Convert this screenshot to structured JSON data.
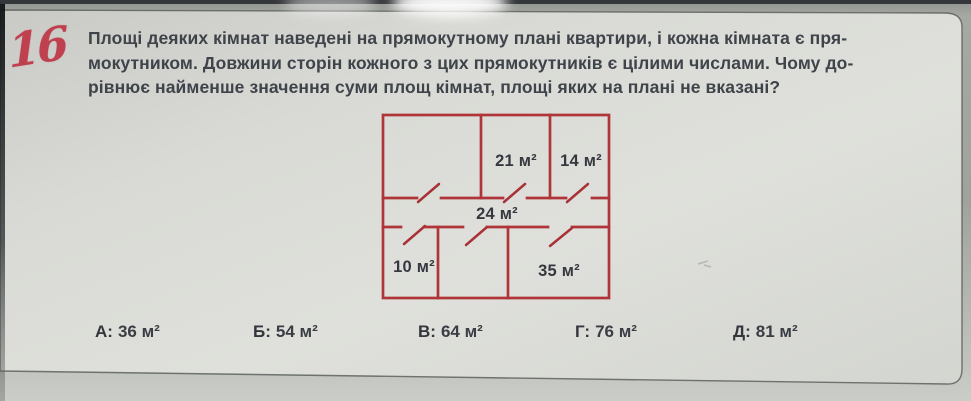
{
  "problem": {
    "number": "16",
    "text_lines": [
      "Площі деяких кімнат наведені на прямокутному плані квартири, і кожна кімната є пря-",
      "мокутником. Довжини сторін кожного з цих прямокутників є цілими числами. Чому до-",
      "рівнює найменше значення суми площ кімнат, площі яких на плані не вказані?"
    ]
  },
  "plan": {
    "room_labels": [
      {
        "text": "21 м²"
      },
      {
        "text": "14 м²"
      },
      {
        "text": "24 м²"
      },
      {
        "text": "10 м²"
      },
      {
        "text": "35 м²"
      }
    ],
    "line_color": "#b03538"
  },
  "answers": {
    "options": [
      {
        "label": "А:",
        "value": "36 м²"
      },
      {
        "label": "Б:",
        "value": "54 м²"
      },
      {
        "label": "В:",
        "value": "64 м²"
      },
      {
        "label": "Г:",
        "value": "76 м²"
      },
      {
        "label": "Д:",
        "value": "81 м²"
      }
    ]
  }
}
